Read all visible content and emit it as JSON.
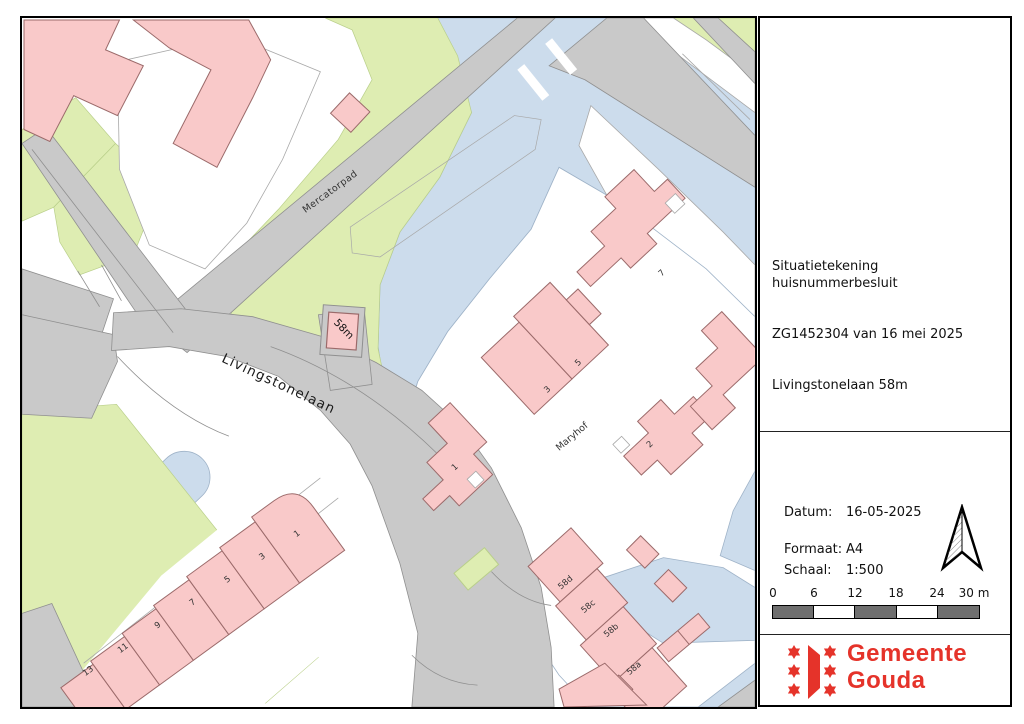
{
  "map": {
    "street_labels": [
      {
        "text": "Mercatorpad"
      },
      {
        "text": "Livingstonelaan"
      },
      {
        "text": "Maryhof"
      }
    ],
    "highlight_label": "58m",
    "house_numbers": {
      "maryhof": [
        "7",
        "5",
        "3",
        "1",
        "2"
      ],
      "bottom_row": [
        "1",
        "3",
        "5",
        "7",
        "9",
        "11",
        "13"
      ],
      "row58": [
        "58d",
        "58c",
        "58b",
        "58a"
      ]
    },
    "colors": {
      "water": "#ccdcec",
      "waterline": "#9fb3c8",
      "green": "#deedb2",
      "greenline": "#b9cf8a",
      "road": "#c9c9c9",
      "roadline": "#8f8f8f",
      "building": "#f9c9c9",
      "buildingline": "#9b6a6a",
      "parcel": "#a8a8a8",
      "white": "#ffffff",
      "scalegray": "#6f6f6f",
      "logored": "#e5332a"
    }
  },
  "title_block": {
    "lines": [
      "Situatietekening  huisnummerbesluit",
      "ZG1452304 van 16 mei 2025",
      "Livingstonelaan 58m"
    ]
  },
  "info_block": {
    "rows": [
      {
        "label": "Datum:",
        "value": "16-05-2025"
      },
      {
        "label": "Formaat:",
        "value": "A4"
      },
      {
        "label": "Schaal:",
        "value": "1:500"
      }
    ]
  },
  "scale_bar": {
    "ticks": [
      "0",
      "6",
      "12",
      "18",
      "24",
      "30 m"
    ]
  },
  "logo": {
    "line1": "Gemeente",
    "line2": "Gouda"
  }
}
